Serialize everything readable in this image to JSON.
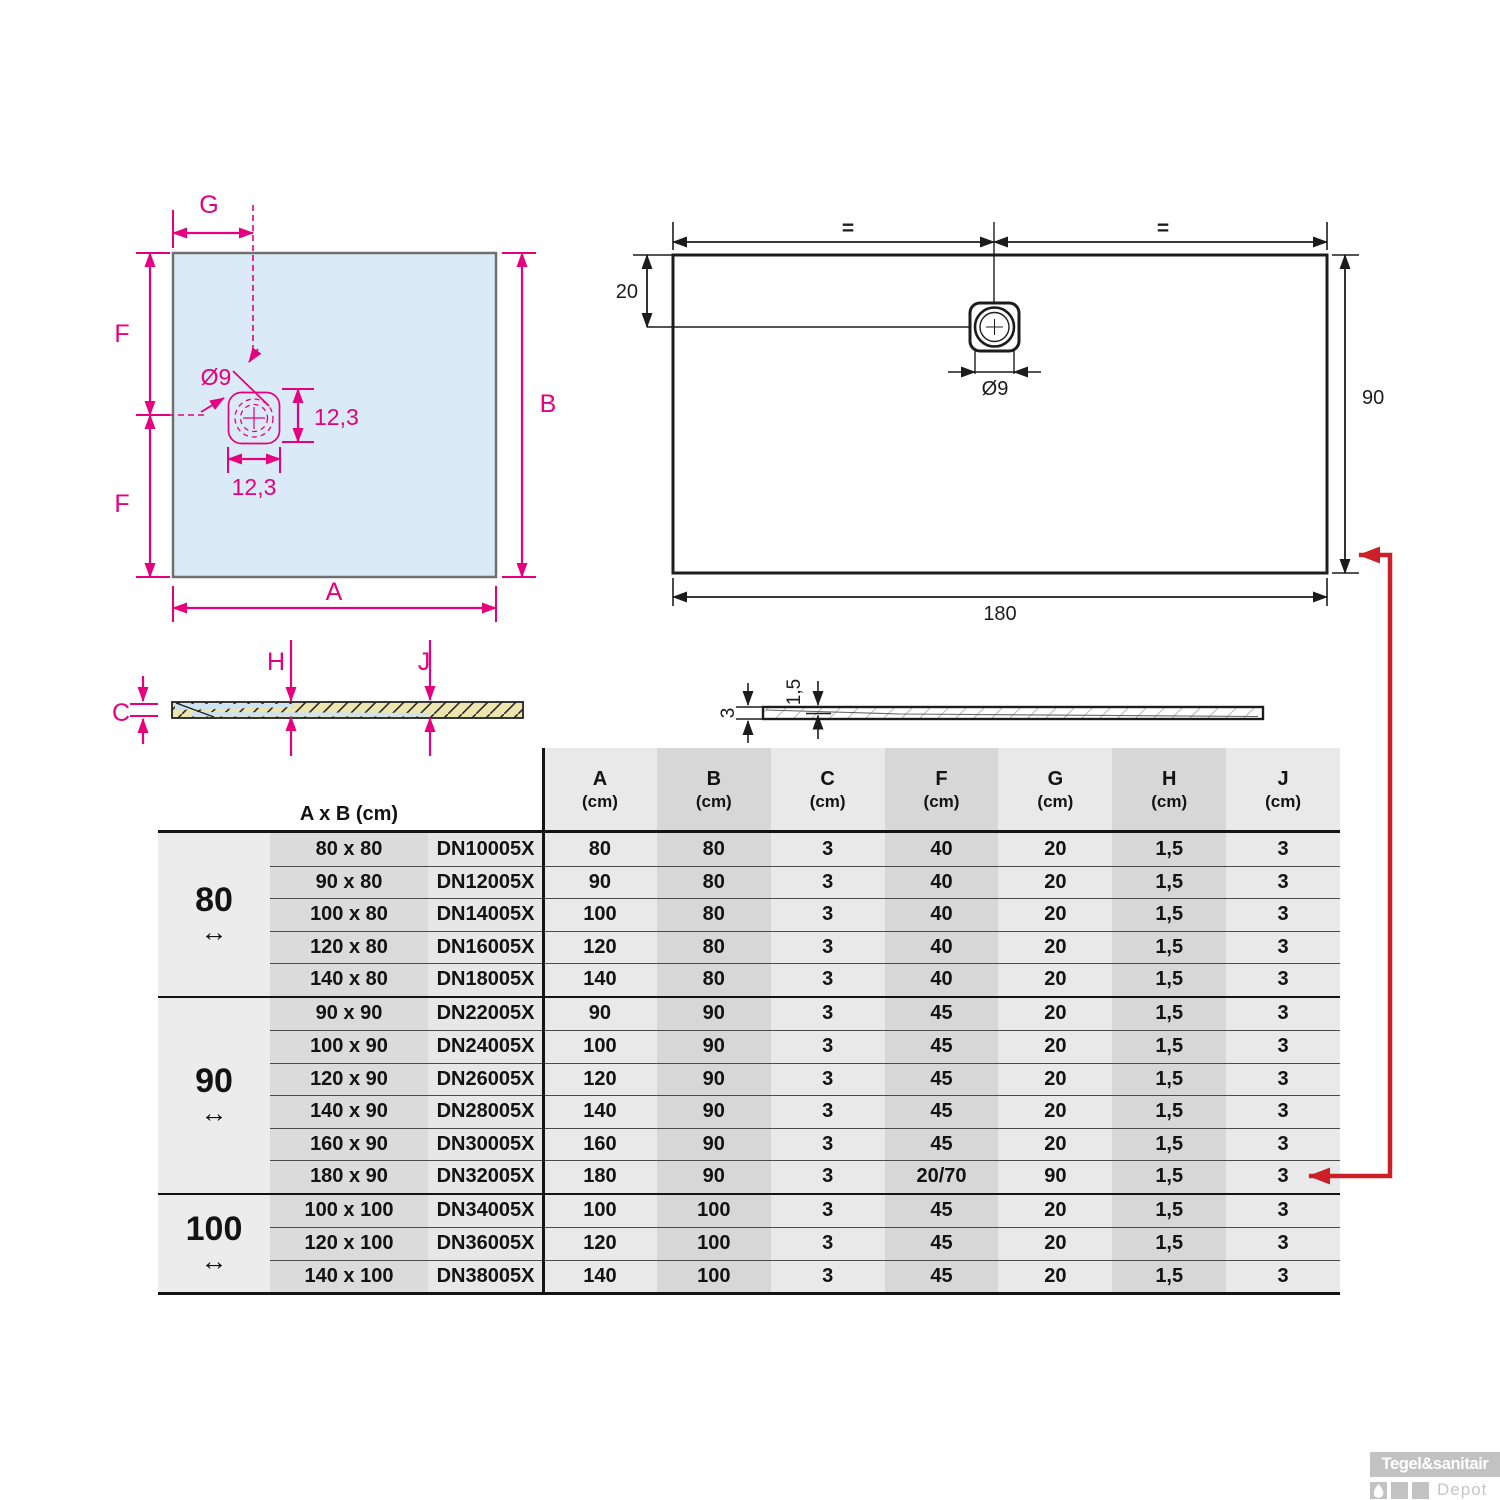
{
  "left_drawing": {
    "labels": {
      "g": "G",
      "f_top": "F",
      "f_bottom": "F",
      "b": "B",
      "a": "A",
      "diameter": "Ø9",
      "drain_height": "12,3",
      "drain_width": "12,3"
    }
  },
  "right_drawing": {
    "labels": {
      "eq_left": "=",
      "eq_right": "=",
      "top_offset": "20",
      "diameter": "Ø9",
      "height": "90",
      "width": "180"
    }
  },
  "left_section": {
    "labels": {
      "c": "C",
      "h": "H",
      "j": "J"
    }
  },
  "right_section": {
    "labels": {
      "depth": "1,5",
      "thickness": "3"
    }
  },
  "table": {
    "corner_header": "A x B (cm)",
    "value_columns": [
      {
        "letter": "A",
        "unit": "(cm)"
      },
      {
        "letter": "B",
        "unit": "(cm)"
      },
      {
        "letter": "C",
        "unit": "(cm)"
      },
      {
        "letter": "F",
        "unit": "(cm)"
      },
      {
        "letter": "G",
        "unit": "(cm)"
      },
      {
        "letter": "H",
        "unit": "(cm)"
      },
      {
        "letter": "J",
        "unit": "(cm)"
      }
    ],
    "groups": [
      {
        "label": "80",
        "arrow": "↔",
        "rows": [
          {
            "size": "80 x 80",
            "code": "DN10005X",
            "values": [
              "80",
              "80",
              "3",
              "40",
              "20",
              "1,5",
              "3"
            ]
          },
          {
            "size": "90 x 80",
            "code": "DN12005X",
            "values": [
              "90",
              "80",
              "3",
              "40",
              "20",
              "1,5",
              "3"
            ]
          },
          {
            "size": "100 x 80",
            "code": "DN14005X",
            "values": [
              "100",
              "80",
              "3",
              "40",
              "20",
              "1,5",
              "3"
            ]
          },
          {
            "size": "120 x 80",
            "code": "DN16005X",
            "values": [
              "120",
              "80",
              "3",
              "40",
              "20",
              "1,5",
              "3"
            ]
          },
          {
            "size": "140 x 80",
            "code": "DN18005X",
            "values": [
              "140",
              "80",
              "3",
              "40",
              "20",
              "1,5",
              "3"
            ]
          }
        ]
      },
      {
        "label": "90",
        "arrow": "↔",
        "rows": [
          {
            "size": "90 x 90",
            "code": "DN22005X",
            "values": [
              "90",
              "90",
              "3",
              "45",
              "20",
              "1,5",
              "3"
            ]
          },
          {
            "size": "100 x 90",
            "code": "DN24005X",
            "values": [
              "100",
              "90",
              "3",
              "45",
              "20",
              "1,5",
              "3"
            ]
          },
          {
            "size": "120 x 90",
            "code": "DN26005X",
            "values": [
              "120",
              "90",
              "3",
              "45",
              "20",
              "1,5",
              "3"
            ]
          },
          {
            "size": "140 x 90",
            "code": "DN28005X",
            "values": [
              "140",
              "90",
              "3",
              "45",
              "20",
              "1,5",
              "3"
            ]
          },
          {
            "size": "160 x 90",
            "code": "DN30005X",
            "values": [
              "160",
              "90",
              "3",
              "45",
              "20",
              "1,5",
              "3"
            ]
          },
          {
            "size": "180 x 90",
            "code": "DN32005X",
            "values": [
              "180",
              "90",
              "3",
              "20/70",
              "90",
              "1,5",
              "3"
            ]
          }
        ]
      },
      {
        "label": "100",
        "arrow": "↔",
        "rows": [
          {
            "size": "100 x 100",
            "code": "DN34005X",
            "values": [
              "100",
              "100",
              "3",
              "45",
              "20",
              "1,5",
              "3"
            ]
          },
          {
            "size": "120 x 100",
            "code": "DN36005X",
            "values": [
              "120",
              "100",
              "3",
              "45",
              "20",
              "1,5",
              "3"
            ]
          },
          {
            "size": "140 x 100",
            "code": "DN38005X",
            "values": [
              "140",
              "100",
              "3",
              "45",
              "20",
              "1,5",
              "3"
            ]
          }
        ]
      }
    ]
  },
  "logo": {
    "brand": "Tegel&sanitair",
    "sub": "Depot"
  },
  "colors": {
    "magenta": "#e6007e",
    "drawing_black": "#1c1c1c",
    "highlight_red": "#cb2027",
    "tray_fill_blue": "#daeaf6",
    "section_yellow": "#ece6ae",
    "table_light": "#e9e9e9",
    "table_dark": "#d7d7d7"
  }
}
